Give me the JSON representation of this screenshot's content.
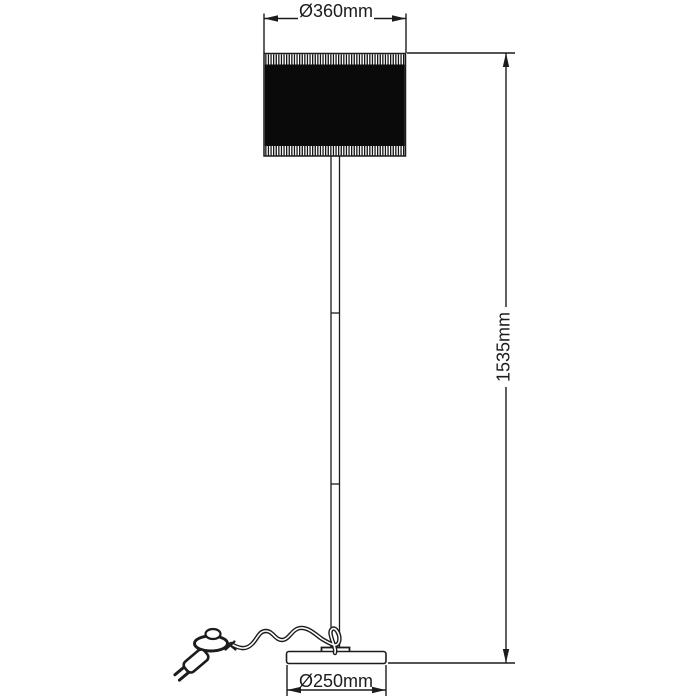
{
  "window": {
    "background": "#ffffff"
  },
  "diagram": {
    "title": "floor-lamp-dimension-drawing",
    "annotations": {
      "shade_diameter": "Ø360mm",
      "total_height": "1535mm",
      "base_diameter": "Ø250mm"
    },
    "style": {
      "line_color": "#1c1c1c",
      "shade_fill": "#0a0a0a",
      "background": "#ffffff",
      "font_size_px": 18
    },
    "parts": [
      "lamp-shade",
      "pole",
      "base",
      "power-cord",
      "foot-switch",
      "mains-plug"
    ]
  }
}
